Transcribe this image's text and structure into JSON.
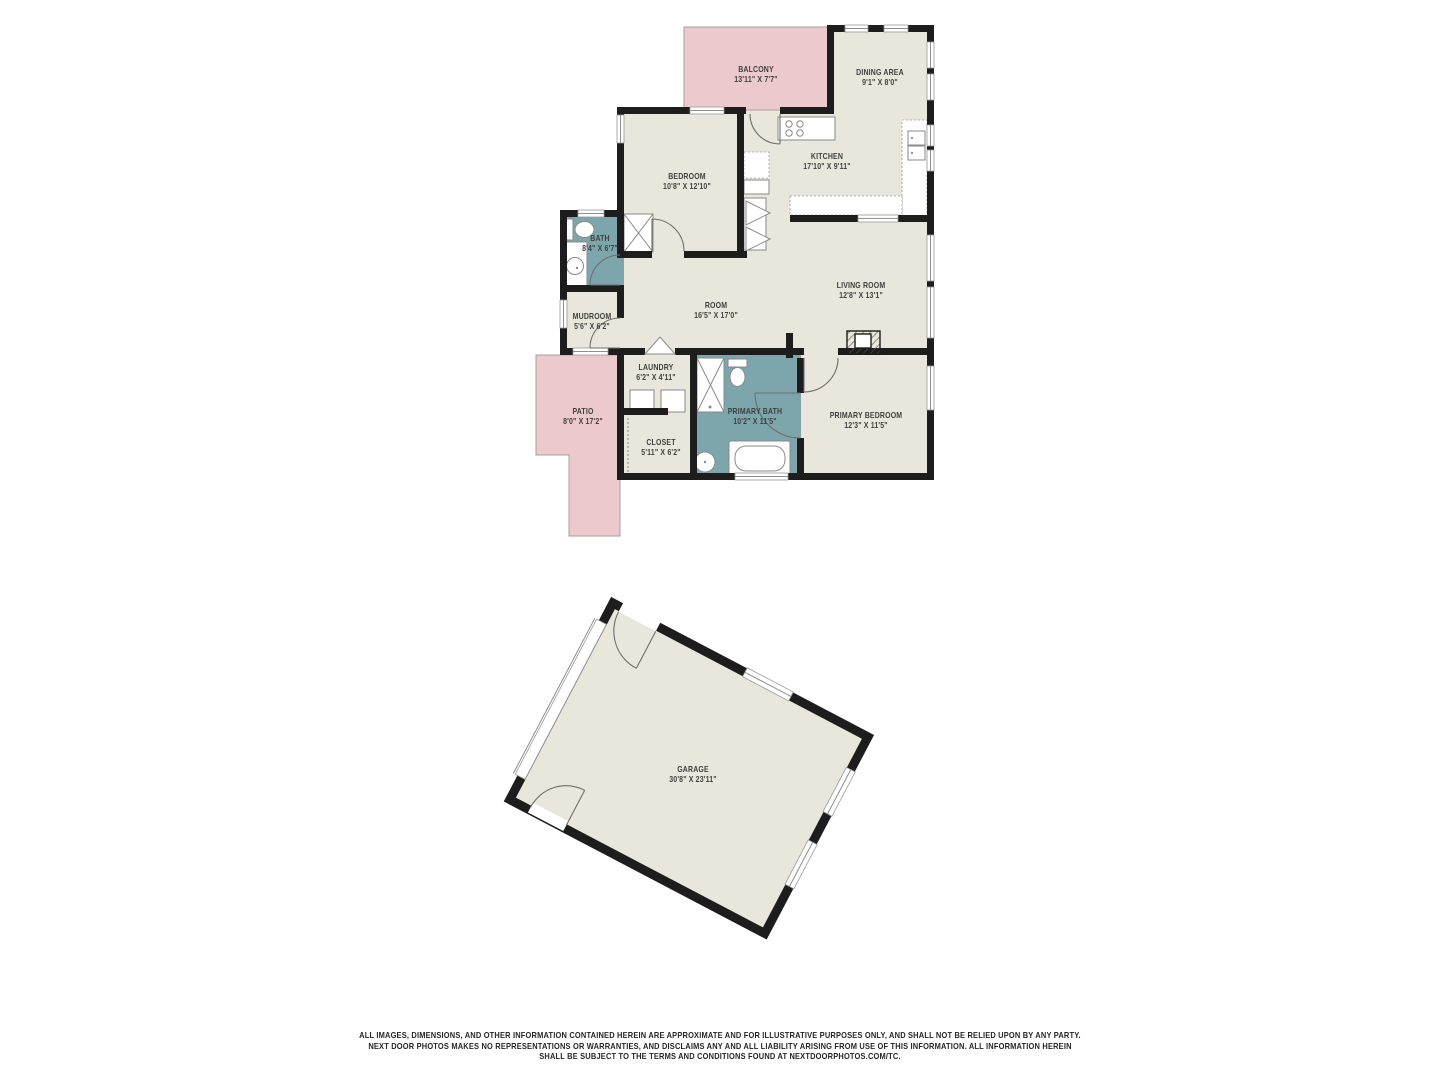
{
  "colors": {
    "floor": "#e9e7dc",
    "wet": "#7ca6ab",
    "outdoor": "#ecc9cc",
    "wall": "#1d1d1d",
    "label": "#3f3f3f"
  },
  "rooms": {
    "balcony": {
      "name": "BALCONY",
      "dims": "13'11\" X 7'7\""
    },
    "dining": {
      "name": "DINING AREA",
      "dims": "9'1\" X 8'0\""
    },
    "kitchen": {
      "name": "KITCHEN",
      "dims": "17'10\" X 9'11\""
    },
    "bedroom": {
      "name": "BEDROOM",
      "dims": "10'8\" X 12'10\""
    },
    "bath": {
      "name": "BATH",
      "dims": "8'4\" X 6'7\""
    },
    "mudroom": {
      "name": "MUDROOM",
      "dims": "5'6\" X 6'2\""
    },
    "room": {
      "name": "ROOM",
      "dims": "16'5\" X 17'0\""
    },
    "living": {
      "name": "LIVING ROOM",
      "dims": "12'8\" X 13'1\""
    },
    "laundry": {
      "name": "LAUNDRY",
      "dims": "6'2\" X 4'11\""
    },
    "primary_bath": {
      "name": "PRIMARY BATH",
      "dims": "10'2\" X 11'5\""
    },
    "closet": {
      "name": "CLOSET",
      "dims": "5'11\" X 6'2\""
    },
    "primary_bedroom": {
      "name": "PRIMARY BEDROOM",
      "dims": "12'3\" X 11'5\""
    },
    "patio": {
      "name": "PATIO",
      "dims": "8'0\" X 17'2\""
    },
    "garage": {
      "name": "GARAGE",
      "dims": "30'8\" X 23'11\""
    }
  },
  "disclaimer": {
    "line1": "ALL IMAGES, DIMENSIONS, AND OTHER INFORMATION CONTAINED HEREIN ARE APPROXIMATE AND FOR ILLUSTRATIVE PURPOSES ONLY, AND SHALL NOT BE RELIED UPON BY ANY PARTY.",
    "line2": "NEXT DOOR PHOTOS MAKES NO REPRESENTATIONS OR WARRANTIES, AND DISCLAIMS ANY AND ALL LIABILITY ARISING FROM USE OF THIS INFORMATION. ALL INFORMATION HEREIN",
    "line3": "SHALL BE SUBJECT TO THE TERMS AND CONDITIONS FOUND AT NEXTDOORPHOTOS.COM/TC."
  }
}
